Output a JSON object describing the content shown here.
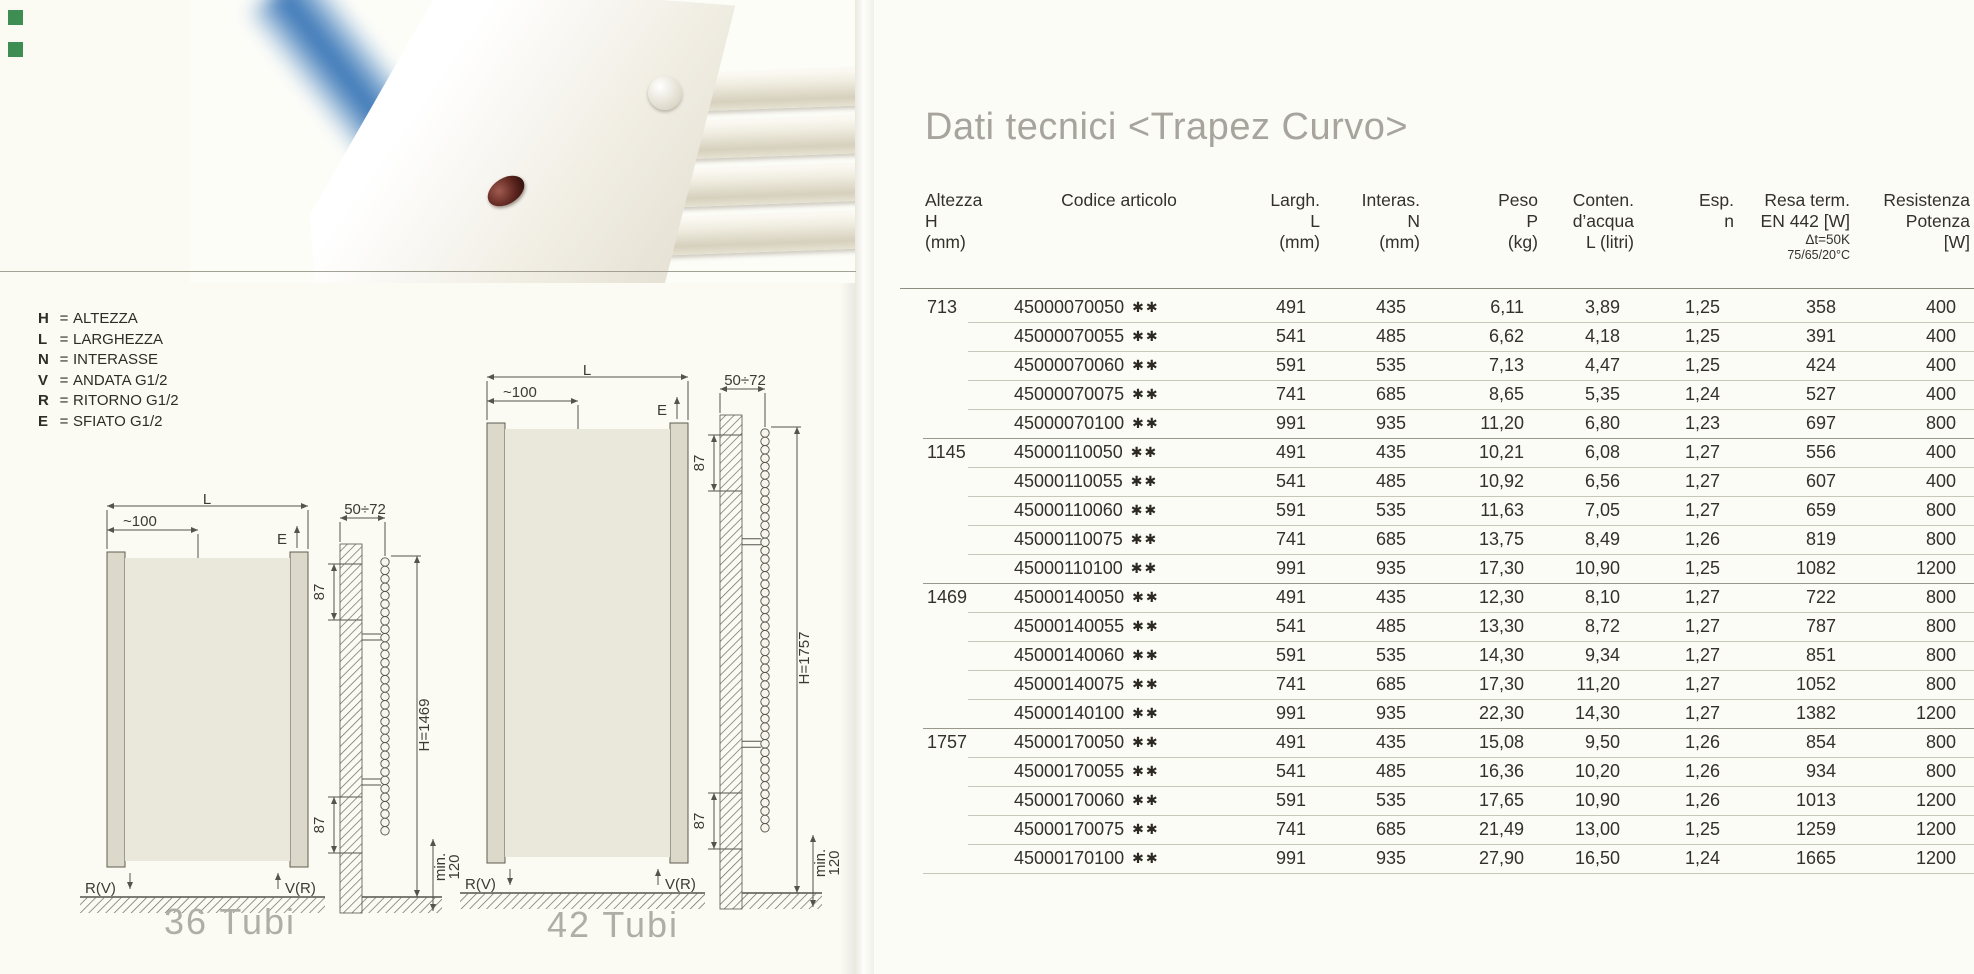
{
  "page": {
    "title": "Dati tecnici <Trapez Curvo>"
  },
  "colors": {
    "corner_marker_green": "#3e8d53",
    "photo_glow_blue": "#2d6db2",
    "title_gray": "#a6a49c"
  },
  "legend": {
    "items": [
      {
        "key": "H",
        "eq": "=",
        "value": "ALTEZZA"
      },
      {
        "key": "L",
        "eq": "=",
        "value": "LARGHEZZA"
      },
      {
        "key": "N",
        "eq": "=",
        "value": "INTERASSE"
      },
      {
        "key": "V",
        "eq": "=",
        "value": "ANDATA G1/2"
      },
      {
        "key": "R",
        "eq": "=",
        "value": "RITORNO G1/2"
      },
      {
        "key": "E",
        "eq": "=",
        "value": "SFIATO G1/2"
      }
    ]
  },
  "drawings": {
    "labels": {
      "width_dim": "L",
      "offset_dim": "~100",
      "vent": "E",
      "wall_depth": "50÷72",
      "top_gap": "87",
      "bottom_gap": "87",
      "floor_min_1": "min.",
      "floor_min_2": "120",
      "return_conn": "R(V)",
      "supply_conn": "V(R)"
    },
    "left": {
      "caption": "36 Tubi",
      "height_dim": "H=1469"
    },
    "right": {
      "caption": "42 Tubi",
      "height_dim": "H=1757"
    }
  },
  "table": {
    "stars": "✱✱",
    "header": {
      "col1": {
        "l1": "Altezza",
        "l2": "H",
        "l3": "(mm)"
      },
      "col2": {
        "l1": "Codice articolo"
      },
      "col3": {
        "l1": "Largh.",
        "l2": "L",
        "l3": "(mm)"
      },
      "col4": {
        "l1": "Interas.",
        "l2": "N",
        "l3": "(mm)"
      },
      "col5": {
        "l1": "Peso",
        "l2": "P",
        "l3": "(kg)"
      },
      "col6": {
        "l1": "Conten.",
        "l2": "d’acqua",
        "l3": "L (litri)"
      },
      "col7": {
        "l1": "Esp.",
        "l2": "n"
      },
      "col8": {
        "l1": "Resa term.",
        "l2": "EN 442 [W]",
        "l3": "Δt=50K",
        "l4": "75/65/20°C"
      },
      "col9": {
        "l1": "Resistenza",
        "l2": "Potenza",
        "l3": "[W]"
      }
    },
    "groups": [
      {
        "height": "713",
        "rows": [
          {
            "code": "45000070050",
            "largh": "491",
            "interas": "435",
            "peso": "6,11",
            "acqua": "3,89",
            "esp": "1,25",
            "resa": "358",
            "potenza": "400"
          },
          {
            "code": "45000070055",
            "largh": "541",
            "interas": "485",
            "peso": "6,62",
            "acqua": "4,18",
            "esp": "1,25",
            "resa": "391",
            "potenza": "400"
          },
          {
            "code": "45000070060",
            "largh": "591",
            "interas": "535",
            "peso": "7,13",
            "acqua": "4,47",
            "esp": "1,25",
            "resa": "424",
            "potenza": "400"
          },
          {
            "code": "45000070075",
            "largh": "741",
            "interas": "685",
            "peso": "8,65",
            "acqua": "5,35",
            "esp": "1,24",
            "resa": "527",
            "potenza": "400"
          },
          {
            "code": "45000070100",
            "largh": "991",
            "interas": "935",
            "peso": "11,20",
            "acqua": "6,80",
            "esp": "1,23",
            "resa": "697",
            "potenza": "800"
          }
        ]
      },
      {
        "height": "1145",
        "rows": [
          {
            "code": "45000110050",
            "largh": "491",
            "interas": "435",
            "peso": "10,21",
            "acqua": "6,08",
            "esp": "1,27",
            "resa": "556",
            "potenza": "400"
          },
          {
            "code": "45000110055",
            "largh": "541",
            "interas": "485",
            "peso": "10,92",
            "acqua": "6,56",
            "esp": "1,27",
            "resa": "607",
            "potenza": "400"
          },
          {
            "code": "45000110060",
            "largh": "591",
            "interas": "535",
            "peso": "11,63",
            "acqua": "7,05",
            "esp": "1,27",
            "resa": "659",
            "potenza": "800"
          },
          {
            "code": "45000110075",
            "largh": "741",
            "interas": "685",
            "peso": "13,75",
            "acqua": "8,49",
            "esp": "1,26",
            "resa": "819",
            "potenza": "800"
          },
          {
            "code": "45000110100",
            "largh": "991",
            "interas": "935",
            "peso": "17,30",
            "acqua": "10,90",
            "esp": "1,25",
            "resa": "1082",
            "potenza": "1200"
          }
        ]
      },
      {
        "height": "1469",
        "rows": [
          {
            "code": "45000140050",
            "largh": "491",
            "interas": "435",
            "peso": "12,30",
            "acqua": "8,10",
            "esp": "1,27",
            "resa": "722",
            "potenza": "800"
          },
          {
            "code": "45000140055",
            "largh": "541",
            "interas": "485",
            "peso": "13,30",
            "acqua": "8,72",
            "esp": "1,27",
            "resa": "787",
            "potenza": "800"
          },
          {
            "code": "45000140060",
            "largh": "591",
            "interas": "535",
            "peso": "14,30",
            "acqua": "9,34",
            "esp": "1,27",
            "resa": "851",
            "potenza": "800"
          },
          {
            "code": "45000140075",
            "largh": "741",
            "interas": "685",
            "peso": "17,30",
            "acqua": "11,20",
            "esp": "1,27",
            "resa": "1052",
            "potenza": "800"
          },
          {
            "code": "45000140100",
            "largh": "991",
            "interas": "935",
            "peso": "22,30",
            "acqua": "14,30",
            "esp": "1,27",
            "resa": "1382",
            "potenza": "1200"
          }
        ]
      },
      {
        "height": "1757",
        "rows": [
          {
            "code": "45000170050",
            "largh": "491",
            "interas": "435",
            "peso": "15,08",
            "acqua": "9,50",
            "esp": "1,26",
            "resa": "854",
            "potenza": "800"
          },
          {
            "code": "45000170055",
            "largh": "541",
            "interas": "485",
            "peso": "16,36",
            "acqua": "10,20",
            "esp": "1,26",
            "resa": "934",
            "potenza": "800"
          },
          {
            "code": "45000170060",
            "largh": "591",
            "interas": "535",
            "peso": "17,65",
            "acqua": "10,90",
            "esp": "1,26",
            "resa": "1013",
            "potenza": "1200"
          },
          {
            "code": "45000170075",
            "largh": "741",
            "interas": "685",
            "peso": "21,49",
            "acqua": "13,00",
            "esp": "1,25",
            "resa": "1259",
            "potenza": "1200"
          },
          {
            "code": "45000170100",
            "largh": "991",
            "interas": "935",
            "peso": "27,90",
            "acqua": "16,50",
            "esp": "1,24",
            "resa": "1665",
            "potenza": "1200"
          }
        ]
      }
    ]
  }
}
